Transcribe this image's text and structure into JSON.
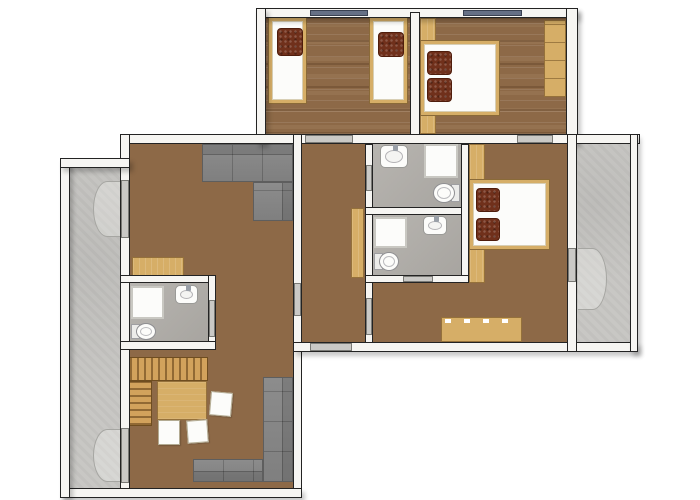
{
  "canvas": {
    "w": 700,
    "h": 500
  },
  "title": "Apartment floor plan",
  "colors": {
    "background": "#ffffff",
    "wood_floor": "#8d6947",
    "wood_furniture": "#d6ae67",
    "wall_fill": "#f6f5f2",
    "wall_line": "#232323",
    "concrete": "#c8c7c4",
    "tile": "#b2afaa",
    "sofa": "#868686",
    "pillow": "#70301b",
    "window": "#667086",
    "door_sill": "#cac9c6",
    "fixture_white": "#fcfcfa"
  },
  "render_order": [
    "floors",
    "arcs",
    "furniture",
    "fixtures",
    "walls",
    "openings"
  ],
  "scene": {
    "floors": [
      {
        "name": "bedroom-top-left-floor",
        "type": "floor-wood-h",
        "x": 266,
        "y": 18,
        "w": 144,
        "h": 116
      },
      {
        "name": "bedroom-top-right-floor",
        "type": "floor-wood-h",
        "x": 420,
        "y": 18,
        "w": 146,
        "h": 116
      },
      {
        "name": "living-dining-floor",
        "type": "floor-wood-v",
        "x": 130,
        "y": 144,
        "w": 163,
        "h": 344
      },
      {
        "name": "hallway-floor",
        "type": "floor-wood-v",
        "x": 302,
        "y": 144,
        "w": 63,
        "h": 198
      },
      {
        "name": "bedroom-middle-floor",
        "type": "floor-wood-v",
        "x": 469,
        "y": 144,
        "w": 98,
        "h": 198
      },
      {
        "name": "bedroom-middle-floor-extension",
        "type": "floor-wood-v",
        "x": 373,
        "y": 283,
        "w": 96,
        "h": 59
      },
      {
        "name": "bathroom-top-floor",
        "type": "floor-tile",
        "x": 373,
        "y": 144,
        "w": 88,
        "h": 63
      },
      {
        "name": "bathroom-middle-floor",
        "type": "floor-tile",
        "x": 373,
        "y": 215,
        "w": 88,
        "h": 60
      },
      {
        "name": "bathroom-left-floor",
        "type": "floor-tile",
        "x": 130,
        "y": 283,
        "w": 78,
        "h": 58
      },
      {
        "name": "balcony-left-floor",
        "type": "floor-concrete",
        "x": 70,
        "y": 168,
        "w": 50,
        "h": 320
      },
      {
        "name": "balcony-right-floor",
        "type": "floor-concrete",
        "x": 577,
        "y": 144,
        "w": 53,
        "h": 198
      }
    ],
    "arcs": [
      {
        "name": "door-swing-arc",
        "type": "arc-left",
        "x": 93,
        "y": 181,
        "w": 29,
        "h": 56
      },
      {
        "name": "door-swing-arc",
        "type": "arc-left",
        "x": 93,
        "y": 429,
        "w": 29,
        "h": 53
      },
      {
        "name": "door-swing-arc",
        "type": "arc-right",
        "x": 578,
        "y": 248,
        "w": 29,
        "h": 62
      }
    ],
    "furniture": [
      {
        "name": "wardrobe-strip-top-right-bedroom",
        "type": "wood",
        "x": 420,
        "y": 18,
        "w": 16,
        "h": 116
      },
      {
        "name": "wardrobe-strip-middle-bedroom",
        "type": "wood",
        "x": 469,
        "y": 144,
        "w": 16,
        "h": 139
      },
      {
        "name": "single-bed-1",
        "type": "bed",
        "x": 268,
        "y": 17,
        "w": 39,
        "h": 87,
        "pillows": [
          {
            "dx": 8,
            "dy": 10,
            "w": 24,
            "h": 26
          }
        ]
      },
      {
        "name": "single-bed-2",
        "type": "bed",
        "x": 369,
        "y": 17,
        "w": 39,
        "h": 87,
        "pillows": [
          {
            "dx": 8,
            "dy": 14,
            "w": 24,
            "h": 23
          }
        ]
      },
      {
        "name": "double-bed-top",
        "type": "bed",
        "x": 420,
        "y": 40,
        "w": 80,
        "h": 76,
        "pillows": [
          {
            "dx": 6,
            "dy": 10,
            "w": 23,
            "h": 22
          },
          {
            "dx": 6,
            "dy": 37,
            "w": 23,
            "h": 22
          }
        ]
      },
      {
        "name": "double-bed-middle",
        "type": "bed",
        "x": 469,
        "y": 179,
        "w": 81,
        "h": 71,
        "pillows": [
          {
            "dx": 6,
            "dy": 8,
            "w": 22,
            "h": 22
          },
          {
            "dx": 6,
            "dy": 38,
            "w": 22,
            "h": 21
          }
        ]
      },
      {
        "name": "wardrobe-top-right",
        "type": "wardrobe",
        "x": 544,
        "y": 20,
        "w": 22,
        "h": 77
      },
      {
        "name": "hallway-cabinet",
        "type": "wood",
        "x": 351,
        "y": 208,
        "w": 13,
        "h": 70
      },
      {
        "name": "sideboard",
        "type": "sideboard",
        "x": 441,
        "y": 317,
        "w": 81,
        "h": 25
      },
      {
        "name": "living-shelf",
        "type": "wood",
        "x": 132,
        "y": 257,
        "w": 52,
        "h": 20
      },
      {
        "name": "sofa-upper-horizontal",
        "type": "sofa-h",
        "back": "top",
        "x": 202,
        "y": 144,
        "w": 91,
        "h": 38
      },
      {
        "name": "sofa-upper-vertical",
        "type": "sofa-v",
        "back": "right",
        "x": 253,
        "y": 182,
        "w": 40,
        "h": 39
      },
      {
        "name": "sofa-lower-vertical",
        "type": "sofa-v",
        "back": "right",
        "x": 263,
        "y": 377,
        "w": 30,
        "h": 105
      },
      {
        "name": "sofa-lower-horizontal",
        "type": "sofa-h",
        "back": "bottom",
        "x": 193,
        "y": 459,
        "w": 70,
        "h": 23
      },
      {
        "name": "dining-bench-top",
        "type": "bench-v",
        "x": 129,
        "y": 357,
        "w": 79,
        "h": 24
      },
      {
        "name": "dining-bench-side",
        "type": "bench-h",
        "x": 129,
        "y": 381,
        "w": 23,
        "h": 45
      },
      {
        "name": "dining-table",
        "type": "table",
        "x": 157,
        "y": 381,
        "w": 50,
        "h": 39
      },
      {
        "name": "dining-chair",
        "type": "chair",
        "x": 210,
        "y": 392,
        "w": 22,
        "h": 24,
        "rot": 5
      },
      {
        "name": "dining-chair",
        "type": "chair",
        "x": 158,
        "y": 420,
        "w": 22,
        "h": 25
      },
      {
        "name": "dining-chair",
        "type": "chair",
        "x": 187,
        "y": 420,
        "w": 21,
        "h": 23,
        "rot": -4
      }
    ],
    "fixtures": [
      {
        "name": "shower-bathroom-top",
        "type": "shower",
        "x": 424,
        "y": 144,
        "w": 34,
        "h": 34
      },
      {
        "name": "sink-bathroom-top",
        "type": "sink",
        "faucet": "top",
        "x": 380,
        "y": 145,
        "w": 28,
        "h": 23
      },
      {
        "name": "toilet-bathroom-top",
        "type": "toilet",
        "tank": "right",
        "x": 433,
        "y": 183,
        "w": 27,
        "h": 20
      },
      {
        "name": "shower-bathroom-middle",
        "type": "shower",
        "x": 374,
        "y": 217,
        "w": 33,
        "h": 31
      },
      {
        "name": "sink-bathroom-middle",
        "type": "sink",
        "faucet": "top",
        "x": 423,
        "y": 216,
        "w": 24,
        "h": 19
      },
      {
        "name": "toilet-bathroom-middle",
        "type": "toilet",
        "tank": "left",
        "x": 374,
        "y": 252,
        "w": 25,
        "h": 19
      },
      {
        "name": "shower-bathroom-left",
        "type": "shower",
        "x": 131,
        "y": 286,
        "w": 33,
        "h": 33
      },
      {
        "name": "sink-bathroom-left",
        "type": "sink",
        "faucet": "top",
        "x": 175,
        "y": 285,
        "w": 23,
        "h": 19
      },
      {
        "name": "toilet-bathroom-left",
        "type": "toilet",
        "tank": "left",
        "x": 131,
        "y": 323,
        "w": 25,
        "h": 17
      }
    ],
    "walls": [
      {
        "name": "wall-top-block-top",
        "type": "wall",
        "ext": true,
        "x": 256,
        "y": 8,
        "w": 322,
        "h": 10
      },
      {
        "name": "wall-top-block-left",
        "type": "wall",
        "ext": true,
        "x": 256,
        "y": 8,
        "w": 10,
        "h": 136
      },
      {
        "name": "wall-top-block-right",
        "type": "wall",
        "ext": true,
        "x": 566,
        "y": 8,
        "w": 12,
        "h": 136
      },
      {
        "name": "wall-top-bedrooms-divider",
        "type": "wall",
        "x": 410,
        "y": 12,
        "w": 10,
        "h": 132
      },
      {
        "name": "wall-middle-band",
        "type": "wall",
        "x": 120,
        "y": 134,
        "w": 520,
        "h": 10
      },
      {
        "name": "wall-living-left",
        "type": "wall",
        "x": 120,
        "y": 134,
        "w": 10,
        "h": 364
      },
      {
        "name": "wall-living-right",
        "type": "wall",
        "x": 293,
        "y": 134,
        "w": 9,
        "h": 364
      },
      {
        "name": "wall-bottom",
        "type": "wall",
        "ext": true,
        "x": 60,
        "y": 488,
        "w": 242,
        "h": 10
      },
      {
        "name": "wall-balcony-left-outer",
        "type": "wall",
        "ext": true,
        "x": 60,
        "y": 158,
        "w": 10,
        "h": 340
      },
      {
        "name": "wall-balcony-left-top",
        "type": "wall",
        "ext": true,
        "x": 60,
        "y": 158,
        "w": 70,
        "h": 10
      },
      {
        "name": "wall-bathroom-left-top",
        "type": "wall",
        "x": 120,
        "y": 275,
        "w": 96,
        "h": 8
      },
      {
        "name": "wall-bathroom-left-right",
        "type": "wall",
        "x": 208,
        "y": 275,
        "w": 8,
        "h": 75
      },
      {
        "name": "wall-bathroom-left-bottom",
        "type": "wall",
        "x": 120,
        "y": 341,
        "w": 96,
        "h": 9
      },
      {
        "name": "wall-hallway-right",
        "type": "wall",
        "x": 365,
        "y": 144,
        "w": 8,
        "h": 200
      },
      {
        "name": "wall-bathrooms-divider",
        "type": "wall",
        "x": 365,
        "y": 207,
        "w": 104,
        "h": 8
      },
      {
        "name": "wall-bathrooms-right",
        "type": "wall",
        "x": 461,
        "y": 144,
        "w": 8,
        "h": 139
      },
      {
        "name": "wall-bathrooms-bottom",
        "type": "wall",
        "x": 365,
        "y": 275,
        "w": 104,
        "h": 8
      },
      {
        "name": "wall-middle-block-bottom",
        "type": "wall",
        "ext": true,
        "x": 293,
        "y": 342,
        "w": 345,
        "h": 10
      },
      {
        "name": "wall-bedroom-balcony",
        "type": "wall",
        "x": 567,
        "y": 134,
        "w": 10,
        "h": 218
      },
      {
        "name": "wall-balcony-right-outer",
        "type": "wall",
        "ext": true,
        "x": 630,
        "y": 134,
        "w": 8,
        "h": 218
      }
    ],
    "openings": [
      {
        "name": "window",
        "type": "window",
        "x": 310,
        "y": 10,
        "w": 58,
        "h": 6
      },
      {
        "name": "window",
        "type": "window",
        "x": 463,
        "y": 10,
        "w": 59,
        "h": 6
      },
      {
        "name": "door-hallway-to-bedroom-top-left",
        "type": "door",
        "x": 305,
        "y": 135,
        "w": 48,
        "h": 8
      },
      {
        "name": "door-bedrooms-connecting",
        "type": "door",
        "x": 517,
        "y": 135,
        "w": 36,
        "h": 8
      },
      {
        "name": "door-living-to-hallway",
        "type": "door",
        "x": 294,
        "y": 283,
        "w": 7,
        "h": 33
      },
      {
        "name": "door-hallway-to-bathroom-top",
        "type": "door",
        "x": 366,
        "y": 165,
        "w": 6,
        "h": 26
      },
      {
        "name": "door-hallway-to-bedroom-middle",
        "type": "door",
        "x": 366,
        "y": 298,
        "w": 6,
        "h": 37
      },
      {
        "name": "door-bathroom-middle",
        "type": "door",
        "x": 403,
        "y": 276,
        "w": 30,
        "h": 6
      },
      {
        "name": "door-entrance",
        "type": "door",
        "x": 310,
        "y": 343,
        "w": 42,
        "h": 8
      },
      {
        "name": "door-bathroom-left",
        "type": "door",
        "x": 209,
        "y": 300,
        "w": 6,
        "h": 37
      },
      {
        "name": "door-balcony-right",
        "type": "door",
        "x": 568,
        "y": 248,
        "w": 8,
        "h": 34
      },
      {
        "name": "door-balcony-left-upper",
        "type": "door",
        "x": 121,
        "y": 180,
        "w": 8,
        "h": 58
      },
      {
        "name": "door-balcony-left-lower",
        "type": "door",
        "x": 121,
        "y": 428,
        "w": 8,
        "h": 55
      }
    ]
  }
}
